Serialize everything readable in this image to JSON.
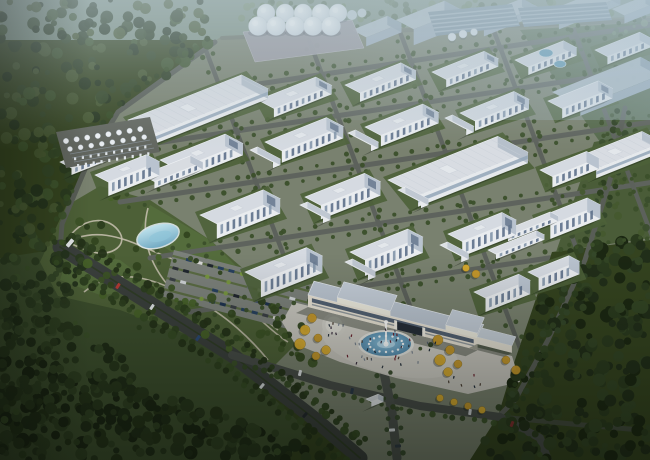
{
  "scene": {
    "width": 650,
    "height": 460,
    "subject": "aerial rendering of an industrial park campus surrounded by forest"
  },
  "palette": {
    "base_ground": "#34431f",
    "campus": "#79816f",
    "field_ne": "#55684a",
    "field_right": "#4a5c38",
    "park": "#4d6037",
    "meadow": "#3c4e2d",
    "path": "#c2bcab",
    "street": "#5e635d",
    "cross_street": "#5c615b",
    "boundary_road": "#585d56",
    "dual_road": "#3a3f3c",
    "front_road": "#474c48",
    "median": "#2f3c26",
    "plaza": "#c7c5be",
    "plaza_light": "#d6d4cc",
    "roof": "#d5dae1",
    "facade": "#e9ecef",
    "end_wall": "#b9c3cf",
    "window": "#5d7089",
    "window_light": "#8396aa",
    "haze_roof": "#b6c3ce",
    "haze_face": "#a2b2c2",
    "haze_end": "#93a5b5",
    "gate_facade": "#e7e1d4",
    "gate_roof": "#b9c3cf",
    "gate_glass": "#47566a",
    "gate_dark": "#262e38",
    "lawn_pad": "#4d6038",
    "shadow": "rgba(22,30,20,0.36)",
    "pond_light": "#bfe2ec",
    "pond_dark": "#73abc4",
    "fountain_water": "#5c9bc0",
    "fountain_rim": "#e3e4e0",
    "silo_light": "#f7fafc",
    "silo_dark": "#ccd6df",
    "apron": "#9b9aa2",
    "basin_base": "#7c91a0",
    "basin_stripe": "#a9bac6",
    "pool": "#5d99b5",
    "yellow_tree": "#d9ab2e",
    "yellow_tree_alt": "#c8992a",
    "hedge": "#55683a",
    "parking_ground": "#7b807a",
    "haze_tint": "#b7c8d0"
  },
  "campus_polygon": [
    [
      222,
      36
    ],
    [
      650,
      16
    ],
    [
      650,
      240
    ],
    [
      552,
      252
    ],
    [
      515,
      360
    ],
    [
      498,
      416
    ],
    [
      470,
      460
    ],
    [
      362,
      460
    ],
    [
      318,
      424
    ],
    [
      232,
      356
    ],
    [
      146,
      302
    ],
    [
      60,
      248
    ],
    [
      62,
      222
    ],
    [
      88,
      160
    ],
    [
      118,
      110
    ]
  ],
  "ne_field_polygon": [
    [
      520,
      30
    ],
    [
      650,
      22
    ],
    [
      650,
      130
    ],
    [
      600,
      142
    ]
  ],
  "right_field_polygon": [
    [
      594,
      142
    ],
    [
      650,
      132
    ],
    [
      650,
      238
    ],
    [
      556,
      252
    ]
  ],
  "meadow_polygon": [
    [
      0,
      258
    ],
    [
      52,
      250
    ],
    [
      148,
      308
    ],
    [
      232,
      360
    ],
    [
      310,
      432
    ],
    [
      286,
      460
    ],
    [
      0,
      460
    ]
  ],
  "park": {
    "polygon": [
      [
        40,
        262
      ],
      [
        66,
        206
      ],
      [
        100,
        186
      ],
      [
        150,
        200
      ],
      [
        210,
        240
      ],
      [
        268,
        290
      ],
      [
        300,
        340
      ],
      [
        268,
        372
      ],
      [
        215,
        345
      ],
      [
        120,
        310
      ],
      [
        58,
        296
      ]
    ],
    "patches": [
      [
        [
          150,
          205
        ],
        [
          210,
          240
        ],
        [
          250,
          280
        ],
        [
          190,
          265
        ],
        [
          140,
          230
        ]
      ],
      [
        [
          70,
          250
        ],
        [
          120,
          260
        ],
        [
          160,
          290
        ],
        [
          100,
          295
        ],
        [
          60,
          280
        ]
      ]
    ],
    "paths": [
      "M60,246 C100,220 135,245 170,258 C205,271 240,300 278,330",
      "M84,292 C120,262 160,282 196,300 C225,314 252,340 268,360",
      "M148,208 C140,238 150,268 176,294",
      "M70,236 C85,216 110,216 120,233 C128,247 108,258 90,251 C76,246 66,244 70,236",
      "M230,300 C255,310 268,330 288,342",
      "M200,262 C220,280 246,296 270,312"
    ],
    "pond": {
      "cx": 158,
      "cy": 236,
      "rx": 21,
      "ry": 11,
      "rot": -16
    },
    "tree_count": 48
  },
  "forest_regions": [
    {
      "poly": [
        [
          0,
          0
        ],
        [
          238,
          0
        ],
        [
          212,
          44
        ],
        [
          116,
          112
        ],
        [
          86,
          162
        ],
        [
          60,
          224
        ],
        [
          40,
          262
        ],
        [
          0,
          300
        ]
      ],
      "count": 240,
      "rmin": 2.5,
      "rmax": 6.5,
      "colors": [
        "#2a3a20",
        "#334526",
        "#3d522c",
        "#24331c",
        "#44552f"
      ],
      "op": 0.95
    },
    {
      "poly": [
        [
          238,
          0
        ],
        [
          650,
          0
        ],
        [
          650,
          24
        ],
        [
          560,
          26
        ],
        [
          238,
          32
        ]
      ],
      "count": 110,
      "rmin": 2,
      "rmax": 4,
      "colors": [
        "#5c7154",
        "#68805c",
        "#51654a",
        "#748a68"
      ],
      "op": 0.85
    },
    {
      "poly": [
        [
          0,
          295
        ],
        [
          44,
          260
        ],
        [
          62,
          232
        ],
        [
          92,
          238
        ],
        [
          74,
          300
        ],
        [
          46,
          346
        ],
        [
          0,
          365
        ]
      ],
      "count": 70,
      "rmin": 2.5,
      "rmax": 5.5,
      "colors": [
        "#2a3a20",
        "#334526",
        "#24331c"
      ],
      "op": 0.95
    },
    {
      "poly": [
        [
          0,
          348
        ],
        [
          70,
          368
        ],
        [
          180,
          398
        ],
        [
          300,
          440
        ],
        [
          330,
          460
        ],
        [
          0,
          460
        ]
      ],
      "count": 240,
      "rmin": 3,
      "rmax": 7,
      "colors": [
        "#1f2c17",
        "#27361c",
        "#2f4022",
        "#1a2513",
        "#243218"
      ],
      "op": 1
    },
    {
      "poly": [
        [
          0,
          300
        ],
        [
          55,
          318
        ],
        [
          150,
          372
        ],
        [
          80,
          420
        ],
        [
          0,
          398
        ]
      ],
      "count": 90,
      "rmin": 3,
      "rmax": 6,
      "colors": [
        "#1f2c17",
        "#27361c",
        "#2f4022"
      ],
      "op": 1
    },
    {
      "poly": [
        [
          560,
          252
        ],
        [
          650,
          236
        ],
        [
          650,
          460
        ],
        [
          476,
          460
        ],
        [
          516,
          362
        ]
      ],
      "count": 260,
      "rmin": 3,
      "rmax": 7,
      "colors": [
        "#212e19",
        "#2a3a1e",
        "#324424",
        "#1b2712"
      ],
      "op": 1
    },
    {
      "poly": [
        [
          594,
          142
        ],
        [
          650,
          132
        ],
        [
          650,
          236
        ],
        [
          560,
          250
        ]
      ],
      "count": 26,
      "rmin": 2,
      "rmax": 4,
      "colors": [
        "#3a4c2c",
        "#45592f"
      ],
      "op": 0.9
    },
    {
      "poly": [
        [
          520,
          30
        ],
        [
          650,
          22
        ],
        [
          650,
          58
        ],
        [
          560,
          50
        ]
      ],
      "count": 12,
      "rmin": 1.5,
      "rmax": 3,
      "colors": [
        "#68805c",
        "#51654a"
      ],
      "op": 0.8
    }
  ],
  "streets": {
    "dir_a": [
      0.989,
      -0.149
    ],
    "dir_b": [
      0.355,
      0.935
    ],
    "a": [
      [
        232,
        88,
        470
      ],
      [
        150,
        144,
        530
      ],
      [
        120,
        202,
        560
      ],
      [
        150,
        258,
        520
      ],
      [
        190,
        312,
        500
      ]
    ],
    "b": [
      [
        205,
        48,
        235
      ],
      [
        309,
        40,
        330
      ],
      [
        400,
        32,
        355
      ],
      [
        492,
        26,
        340
      ],
      [
        570,
        20,
        310
      ]
    ],
    "width_a": 5,
    "width_b": 4.5
  },
  "roads": {
    "boundary_west": [
      [
        215,
        42
      ],
      [
        118,
        112
      ],
      [
        88,
        162
      ],
      [
        62,
        224
      ],
      [
        60,
        250
      ]
    ],
    "boundary_east": [
      [
        625,
        108
      ],
      [
        610,
        180
      ],
      [
        585,
        260
      ],
      [
        548,
        340
      ],
      [
        515,
        400
      ],
      [
        498,
        417
      ]
    ],
    "north_edge": [
      [
        222,
        38
      ],
      [
        650,
        20
      ]
    ],
    "dual": {
      "points": [
        [
          60,
          247
        ],
        [
          148,
          302
        ],
        [
          232,
          355
        ],
        [
          316,
          420
        ],
        [
          360,
          458
        ]
      ],
      "width": 15
    },
    "front": [
      [
        232,
        355
      ],
      [
        330,
        385
      ],
      [
        420,
        406
      ],
      [
        500,
        417
      ],
      [
        540,
        438
      ],
      [
        548,
        460
      ]
    ],
    "front_east": [
      [
        500,
        417
      ],
      [
        572,
        424
      ],
      [
        640,
        430
      ]
    ],
    "access": [
      [
        383,
        368
      ],
      [
        392,
        412
      ],
      [
        397,
        458
      ]
    ]
  },
  "parking": {
    "origin": [
      174,
      250
    ],
    "e1": [
      0.966,
      0.25
    ],
    "perp": [
      -0.25,
      0.966
    ],
    "rows": 4,
    "row_len": 152,
    "row_gap": 11.5,
    "stall_gap": 11,
    "extent": 48,
    "car_colors": [
      "#1e3350",
      "#2b2f36",
      "#58131a",
      "#d8d8d6",
      "#27405f",
      "#3a3f45",
      "#cfd3d6",
      "#20262e",
      "#43506b",
      "#6b7076"
    ],
    "bush_color": "#7a9a3f"
  },
  "plaza": {
    "polygon": [
      [
        293,
        302
      ],
      [
        512,
        356
      ],
      [
        520,
        382
      ],
      [
        468,
        394
      ],
      [
        396,
        378
      ],
      [
        340,
        362
      ],
      [
        295,
        344
      ],
      [
        282,
        322
      ]
    ],
    "circle": {
      "cx": 334,
      "cy": 325,
      "r": 12
    }
  },
  "fountain": {
    "cx": 386,
    "cy": 344,
    "rx": 28,
    "ry": 14,
    "jets": 16
  },
  "gate": {
    "x": 308,
    "y": 295,
    "l": 175,
    "d": 15,
    "h": 12,
    "west_block": {
      "s": 30,
      "len": 55,
      "rise": 5
    },
    "east_block": {
      "s": 142,
      "len": 33,
      "rise": 5
    },
    "passage": {
      "s1": 92,
      "s2": 118
    },
    "annex": {
      "x": 477,
      "y": 337,
      "l": 36,
      "d": 10,
      "h": 7
    }
  },
  "buildings": [
    [
      352,
      30,
      38,
      16,
      9,
      "haze"
    ],
    [
      396,
      20,
      52,
      20,
      16,
      "haze"
    ],
    [
      468,
      20,
      58,
      18,
      8,
      "haze"
    ],
    [
      543,
      13,
      66,
      18,
      8,
      "haze"
    ],
    [
      612,
      9,
      36,
      14,
      8,
      "haze"
    ],
    [
      552,
      92,
      95,
      32,
      9,
      "haze"
    ],
    [
      128,
      120,
      122,
      30,
      10,
      "warehouse"
    ],
    [
      388,
      180,
      118,
      34,
      11,
      "warehouse"
    ],
    [
      575,
      158,
      72,
      24,
      9,
      "warehouse"
    ],
    [
      258,
      100,
      62,
      18,
      9
    ],
    [
      345,
      85,
      60,
      17,
      9
    ],
    [
      432,
      72,
      56,
      16,
      8
    ],
    [
      515,
      60,
      52,
      15,
      8
    ],
    [
      595,
      50,
      48,
      14,
      8
    ],
    [
      160,
      160,
      70,
      20,
      12
    ],
    [
      265,
      142,
      66,
      19,
      12
    ],
    [
      365,
      127,
      62,
      18,
      11
    ],
    [
      460,
      113,
      58,
      17,
      10
    ],
    [
      548,
      101,
      54,
      16,
      10
    ],
    [
      200,
      215,
      68,
      19,
      15
    ],
    [
      305,
      197,
      64,
      18,
      14
    ],
    [
      540,
      170,
      50,
      14,
      11
    ],
    [
      245,
      272,
      66,
      18,
      17
    ],
    [
      350,
      252,
      62,
      17,
      16
    ],
    [
      448,
      234,
      58,
      16,
      15
    ],
    [
      537,
      218,
      54,
      15,
      14
    ],
    [
      474,
      292,
      48,
      13,
      14
    ],
    [
      528,
      272,
      44,
      12,
      13
    ],
    [
      95,
      175,
      55,
      15,
      14
    ],
    [
      60,
      162,
      46,
      13,
      7,
      "small"
    ],
    [
      142,
      175,
      52,
      14,
      7,
      "small"
    ],
    [
      500,
      232,
      54,
      9,
      5,
      "small"
    ],
    [
      488,
      250,
      52,
      9,
      5,
      "small"
    ],
    [
      366,
      399,
      13,
      6,
      5,
      "small"
    ],
    [
      250,
      150,
      8,
      26,
      6,
      "bridge"
    ],
    [
      348,
      133,
      8,
      26,
      6,
      "bridge"
    ],
    [
      445,
      118,
      8,
      24,
      6,
      "bridge"
    ],
    [
      300,
      205,
      8,
      26,
      6,
      "bridge"
    ],
    [
      398,
      190,
      8,
      26,
      6,
      "bridge"
    ],
    [
      345,
      262,
      8,
      26,
      6,
      "bridge"
    ],
    [
      440,
      245,
      8,
      24,
      6,
      "bridge"
    ]
  ],
  "geometry": {
    "u": [
      0.93,
      -0.37
    ],
    "w": [
      0.885,
      0.465
    ]
  },
  "silos": {
    "rows": [
      {
        "y": 13,
        "r": 9,
        "xs": [
          266,
          285,
          303,
          321,
          338
        ]
      },
      {
        "y": 26,
        "r": 9.5,
        "xs": [
          258,
          276,
          295,
          313,
          331
        ]
      }
    ],
    "extras": [
      [
        352,
        15,
        5
      ],
      [
        362,
        13,
        4.5
      ]
    ]
  },
  "apron": [
    [
      243,
      32
    ],
    [
      352,
      20
    ],
    [
      364,
      48
    ],
    [
      255,
      62
    ]
  ],
  "tank_farm": {
    "quad": [
      [
        56,
        132
      ],
      [
        150,
        117
      ],
      [
        160,
        152
      ],
      [
        66,
        168
      ]
    ],
    "ground": "#62665f"
  },
  "basins": [
    {
      "quad": [
        [
          428,
          12
        ],
        [
          512,
          4
        ],
        [
          520,
          26
        ],
        [
          436,
          36
        ]
      ],
      "stripes": 5
    },
    {
      "quad": [
        [
          518,
          8
        ],
        [
          606,
          2
        ],
        [
          612,
          20
        ],
        [
          524,
          27
        ]
      ],
      "stripes": 4
    }
  ],
  "pools": [
    [
      546,
      53,
      7,
      4
    ],
    [
      560,
      64,
      6,
      3.5
    ]
  ],
  "domes": [
    [
      452,
      37,
      4
    ],
    [
      463,
      34,
      4
    ],
    [
      474,
      32,
      3.5
    ]
  ],
  "yellow_trees": [
    [
      312,
      318,
      4.5
    ],
    [
      305,
      330,
      5
    ],
    [
      318,
      338,
      4
    ],
    [
      300,
      344,
      5.5
    ],
    [
      326,
      350,
      4.5
    ],
    [
      316,
      356,
      4
    ],
    [
      438,
      340,
      5
    ],
    [
      450,
      350,
      4.5
    ],
    [
      440,
      360,
      5.5
    ],
    [
      458,
      364,
      4
    ],
    [
      448,
      372,
      4.5
    ],
    [
      506,
      360,
      4
    ],
    [
      516,
      370,
      4.5
    ],
    [
      466,
      268,
      3.5
    ],
    [
      476,
      274,
      4
    ],
    [
      440,
      398,
      3.5
    ],
    [
      454,
      402,
      3.5
    ],
    [
      468,
      406,
      3.5
    ],
    [
      482,
      410,
      3.5
    ]
  ],
  "people": {
    "zones": [
      {
        "cx": 388,
        "cy": 348,
        "rx": 52,
        "ry": 20,
        "n": 34
      },
      {
        "cx": 334,
        "cy": 327,
        "rx": 14,
        "ry": 10,
        "n": 8
      },
      {
        "cx": 468,
        "cy": 380,
        "rx": 20,
        "ry": 8,
        "n": 6
      }
    ],
    "colors": [
      "#2e3742",
      "#4a3d33",
      "#6e2430",
      "#1f2a38",
      "#57616e",
      "#7a8491",
      "#3a2f3f"
    ]
  },
  "cars": [
    [
      118,
      286,
      33,
      "#b43a34"
    ],
    [
      152,
      307,
      33,
      "#dde1e4"
    ],
    [
      198,
      338,
      36,
      "#2b4a74"
    ],
    [
      262,
      386,
      40,
      "#d3d7da"
    ],
    [
      305,
      415,
      42,
      "#23282e"
    ],
    [
      70,
      243,
      40,
      "#e6e9ec",
      4,
      9
    ],
    [
      300,
      373,
      14,
      "#dde0e3"
    ],
    [
      352,
      391,
      12,
      "#2a3848"
    ],
    [
      470,
      412,
      8,
      "#caced2"
    ],
    [
      512,
      424,
      22,
      "#7e2e2e"
    ],
    [
      392,
      430,
      86,
      "#d8dce0"
    ],
    [
      398,
      446,
      86,
      "#303a46"
    ]
  ]
}
